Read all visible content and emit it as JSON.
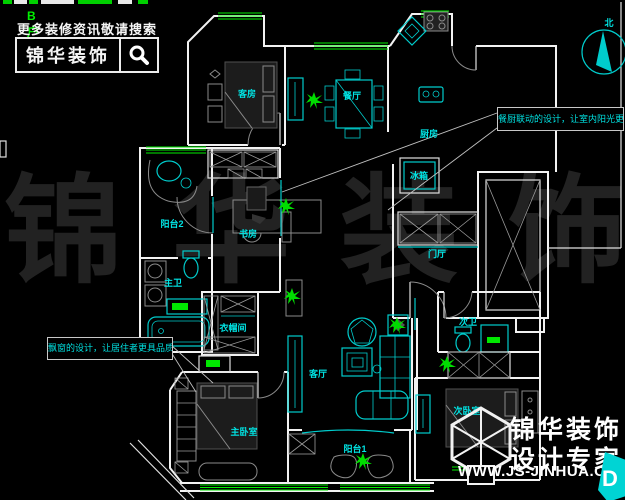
{
  "promo": {
    "tag": "B户型",
    "headline": "更多装修资讯敬请搜索",
    "brand": "锦华装饰"
  },
  "watermark": "锦华装饰",
  "plan": {
    "north_label": "北",
    "rooms": {
      "guest_room": "客房",
      "dining": "餐厅",
      "kitchen": "厨房",
      "fridge": "冰箱",
      "balcony2": "阳台2",
      "study": "书房",
      "master_bath": "主卫",
      "closet": "衣帽间",
      "foyer": "门厅",
      "living": "客厅",
      "master_bedroom": "主卧室",
      "balcony1": "阳台1",
      "second_bath": "次卫",
      "second_bedroom": "次卧室"
    },
    "callout_right": "餐厨联动的设计，让室内阳光更加充足",
    "callout_left": "飘窗的设计，让居住者更具品质感"
  },
  "logo": {
    "brand": "锦华装饰",
    "tagline": "设计专家",
    "website": "WWW.JS-JINHUA.COM",
    "compass_letter": "D"
  },
  "colors": {
    "background": "#000000",
    "walls": "#f2f2f2",
    "fixtures_cyan": "#00cccc",
    "labels_cyan": "#00e4e4",
    "windows_green": "#00ee00",
    "plants_green": "#00dd00",
    "watermark_gray": "#222222"
  }
}
